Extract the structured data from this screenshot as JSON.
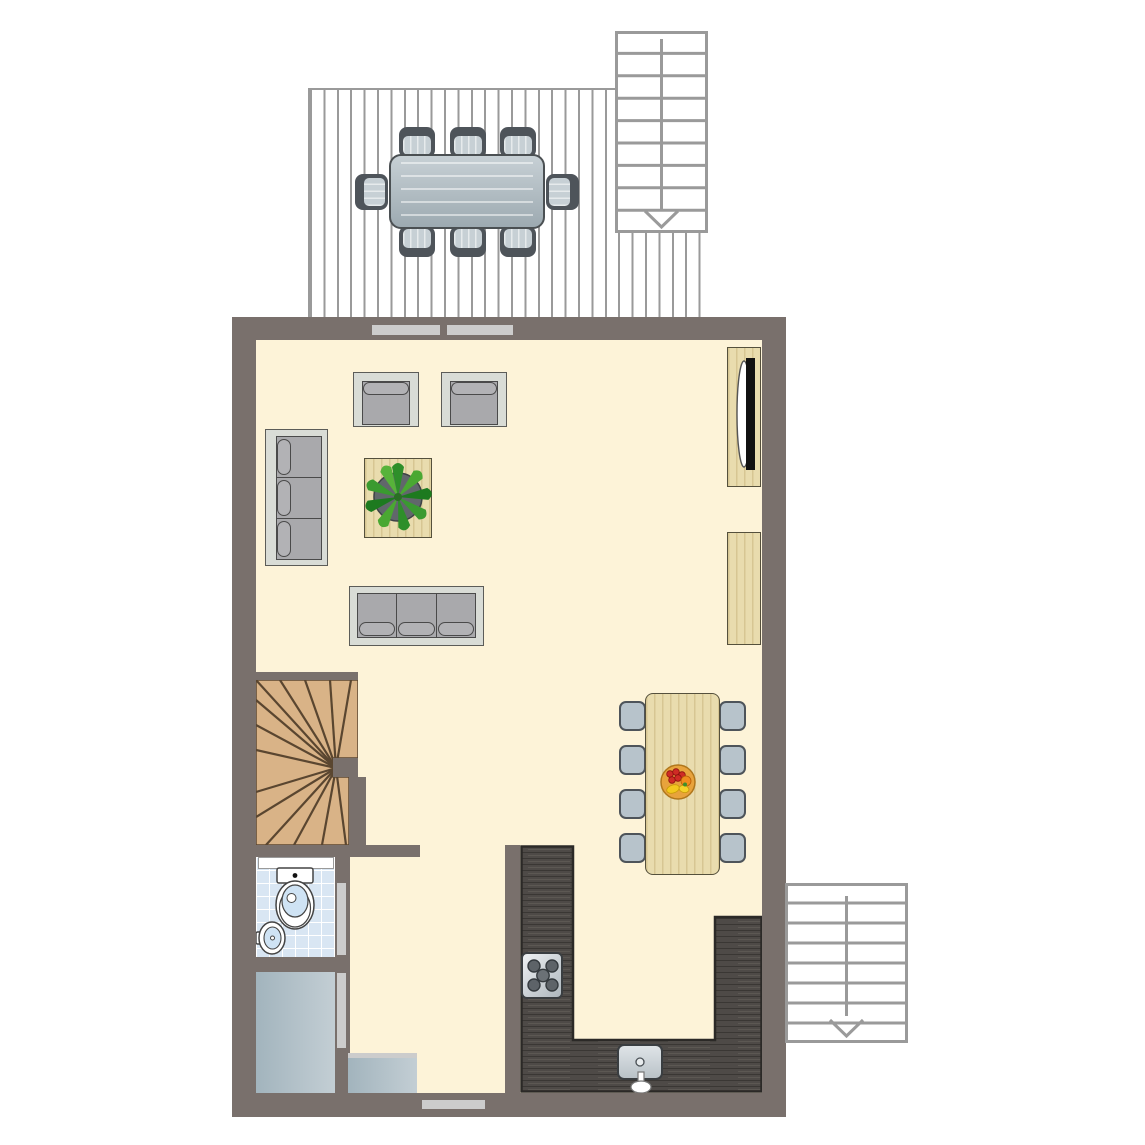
{
  "scene": {
    "type": "residential floor plan, top-down view, no text labels",
    "areas": [
      "deck-terrace",
      "living-room",
      "dining-area",
      "kitchen",
      "bathroom",
      "storage",
      "winder-staircase",
      "two-exterior-staircases"
    ]
  },
  "outdoor": {
    "deck": {
      "plank_direction": "vertical",
      "planks_visible": 30
    },
    "deck_dining_set": {
      "table": "rectangular gray outdoor table",
      "chairs": 8,
      "chair_layout": "3 top, 3 bottom, 1 left, 1 right"
    },
    "stairs_top_right": {
      "steps": 9,
      "arrow": "down"
    },
    "stairs_bottom_right": {
      "steps": 8,
      "arrow": "down"
    }
  },
  "interior": {
    "living_room": {
      "armchairs": 2,
      "three_seat_sofas": 2,
      "coffee_table_with_plant": 1,
      "tv_cabinet_with_tv": 1,
      "sideboard": 1
    },
    "dining_area": {
      "table": "light wood rectangular",
      "chairs": 8,
      "fruit_bowl": 1
    },
    "kitchen": {
      "counter_shape": "U",
      "stove_burners": 4,
      "sink": 1
    },
    "bathroom": {
      "toilet": 1,
      "hand_basin": 1,
      "shelf": 1
    },
    "winder_staircase_treads": 15,
    "storage_units": 2,
    "openings": {
      "windows_top_wall": 2,
      "window_bottom_wall": 1,
      "interior_door_strips": 2
    }
  },
  "palette": {
    "wall": "#79706c",
    "floor": "#fdf3d8",
    "line": "#9a9a9a",
    "wood": "#e9dcae",
    "wood-edge": "#55503c",
    "stair-wood": "#d9b387",
    "stair-line": "#5a4630",
    "counter": "#4e4a47",
    "counter-edge": "#2b2927",
    "tile": "#d9e6f3",
    "water": "#cfe3f4",
    "utility-a": "#a2b4bd",
    "utility-b": "#c3ced4",
    "door": "#cccccc",
    "sofa-frame": "#d9dcd6",
    "cushion": "#a9a9ac",
    "cushion-edge": "#4a4a4a",
    "seat": "#b7c3cb",
    "seat-frame": "#4e545a",
    "table-gray-a": "#c7d0d5",
    "table-gray-b": "#9daab1",
    "plant-green": "#3a9a30",
    "pot": "#61676b",
    "fruit-bowl": "#e9a83e"
  }
}
